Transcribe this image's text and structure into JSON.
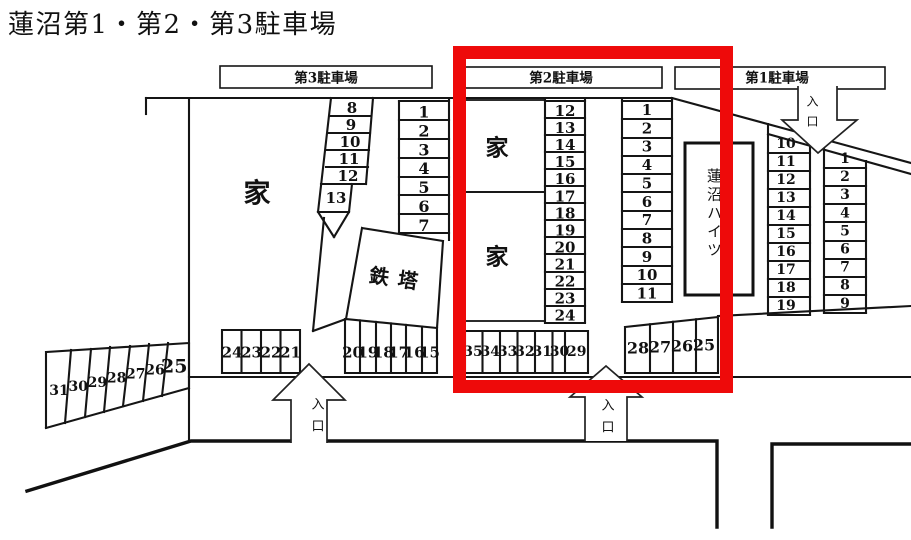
{
  "title": "蓮沼第1・第2・第3駐車場",
  "highlight_color": "#ee0a0a",
  "labels": {
    "house": "家",
    "tower": "鉄塔",
    "entrance": "入口",
    "building": "蓮沼ハイツ"
  },
  "lot3": {
    "name": "第3駐車場",
    "col_right": [
      "1",
      "2",
      "3",
      "4",
      "5",
      "6",
      "7"
    ],
    "col_slant": [
      "8",
      "9",
      "10",
      "11",
      "12"
    ],
    "space13": [
      "13"
    ],
    "row_left": [
      "24",
      "23",
      "22",
      "21"
    ],
    "row_right": [
      "20",
      "19",
      "18",
      "17",
      "16",
      "15"
    ],
    "row_road": [
      "31",
      "30",
      "29",
      "28",
      "27",
      "26",
      "25"
    ]
  },
  "lot2": {
    "name": "第2駐車場",
    "col_mid": [
      "12",
      "13",
      "14",
      "15",
      "16",
      "17",
      "18",
      "19",
      "20",
      "21",
      "22",
      "23",
      "24"
    ],
    "col_right": [
      "1",
      "2",
      "3",
      "4",
      "5",
      "6",
      "7",
      "8",
      "9",
      "10",
      "11"
    ],
    "row_left": [
      "35",
      "34",
      "33",
      "32",
      "31",
      "30",
      "29"
    ],
    "row_right": [
      "28",
      "27",
      "26",
      "25"
    ]
  },
  "lot1": {
    "name": "第1駐車場",
    "col_left": [
      "10",
      "11",
      "12",
      "13",
      "14",
      "15",
      "16",
      "17",
      "18",
      "19"
    ],
    "col_right": [
      "1",
      "2",
      "3",
      "4",
      "5",
      "6",
      "7",
      "8",
      "9"
    ]
  }
}
